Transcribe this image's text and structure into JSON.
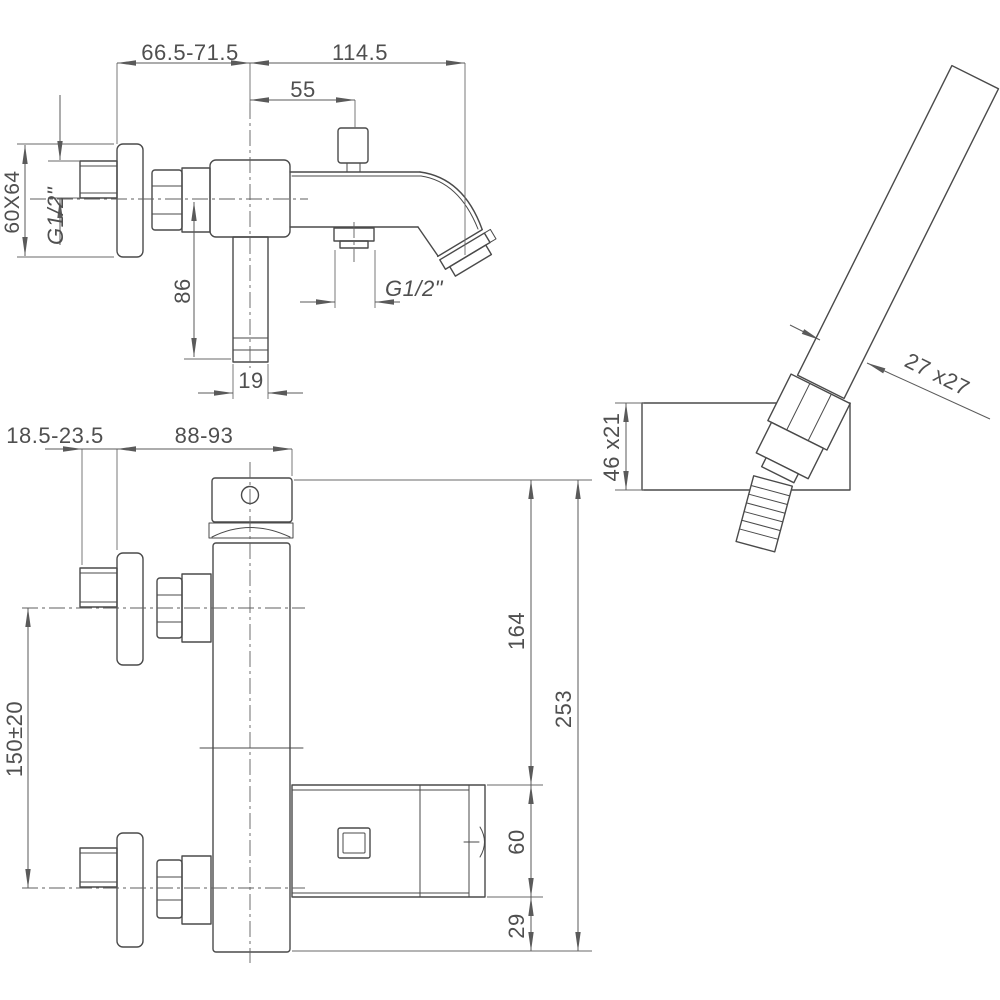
{
  "drawing": {
    "type": "technical-drawing",
    "subject": "wall-mounted bath shower mixer with hand shower, dimensioned views",
    "background": "#ffffff",
    "line_color": "#4a4a4a",
    "dimension_color": "#5a5a5a"
  },
  "dimensions": {
    "side_view": {
      "wall_to_center": "66.5-71.5",
      "spout_reach": "114.5",
      "center_to_diverter": "55",
      "flange_size": "60X64",
      "inlet_thread": "G1/2\"",
      "drop_length": "86",
      "drop_width": "19",
      "outlet_thread": "G1/2\""
    },
    "front_view": {
      "fitting_depth": "18.5-23.5",
      "wall_to_body": "88-93",
      "inlet_spacing": "150±20",
      "handle_to_spout": "164",
      "overall_height": "253",
      "spout_height": "60",
      "spout_to_bottom": "29"
    },
    "handshower": {
      "wand_section": "27 x27",
      "holder_size": "46 x21"
    }
  }
}
